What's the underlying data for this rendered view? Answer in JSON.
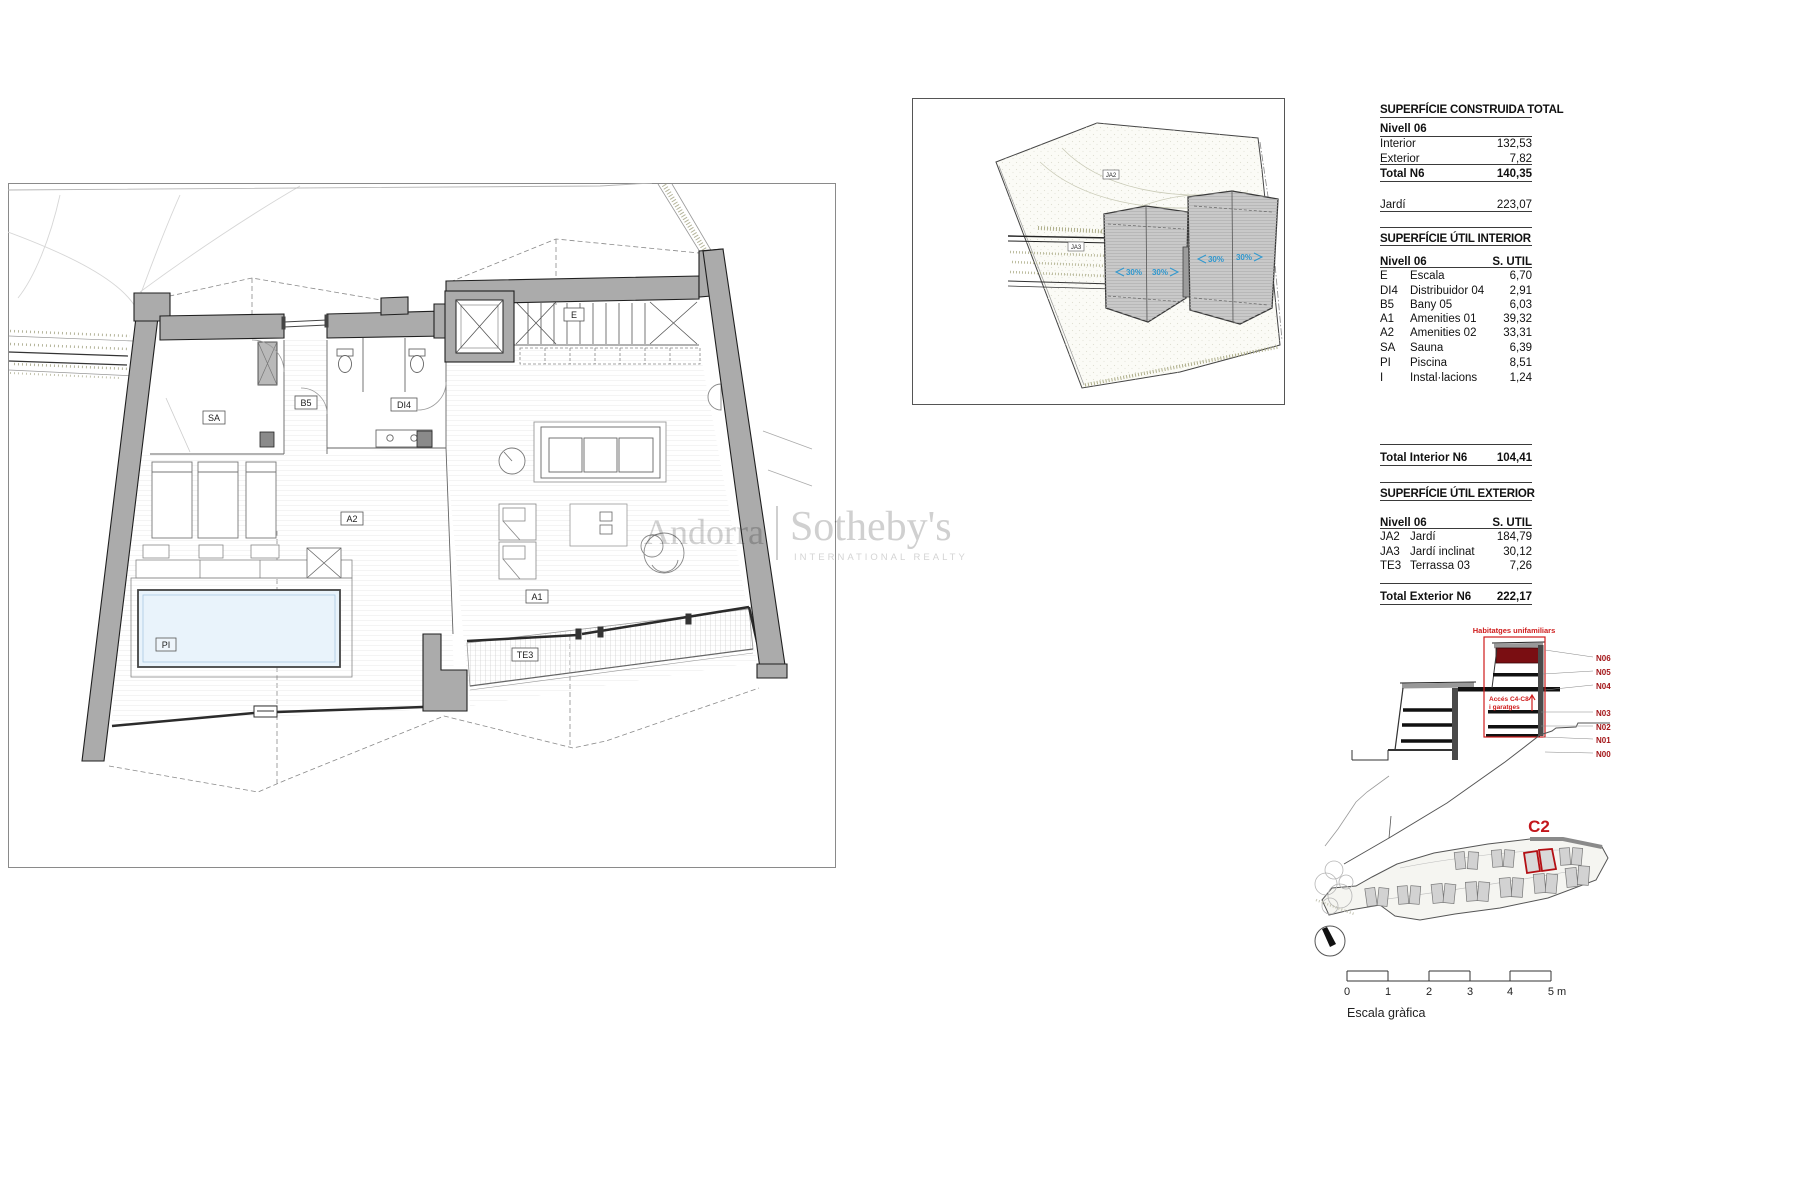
{
  "watermark": {
    "left": "Andorra",
    "right": "Sotheby's",
    "tagline": "INTERNATIONAL REALTY"
  },
  "plan": {
    "labels": {
      "sa": "SA",
      "b5": "B5",
      "di4": "DI4",
      "a2": "A2",
      "a1": "A1",
      "pi": "PI",
      "te3": "TE3",
      "e": "E"
    }
  },
  "site_plan": {
    "labels": {
      "ja2": "JA2",
      "ja3": "JA3"
    },
    "slopes": [
      "30%",
      "30%",
      "30%",
      "30%"
    ]
  },
  "tables": {
    "construida": {
      "title": "SUPERFÍCIE CONSTRUIDA TOTAL",
      "subtitle": "Nivell 06",
      "rows": [
        {
          "label": "Interior",
          "value": "132,53"
        },
        {
          "label": "Exterior",
          "value": "7,82"
        }
      ],
      "total_label": "Total N6",
      "total_value": "140,35",
      "jardi_label": "Jardí",
      "jardi_value": "223,07"
    },
    "util_interior": {
      "title": "SUPERFÍCIE ÚTIL INTERIOR",
      "header_left": "Nivell 06",
      "header_right": "S. UTIL",
      "rows": [
        {
          "code": "E",
          "label": "Escala",
          "value": "6,70"
        },
        {
          "code": "DI4",
          "label": "Distribuidor 04",
          "value": "2,91"
        },
        {
          "code": "B5",
          "label": "Bany 05",
          "value": "6,03"
        },
        {
          "code": "A1",
          "label": "Amenities 01",
          "value": "39,32"
        },
        {
          "code": "A2",
          "label": "Amenities 02",
          "value": "33,31"
        },
        {
          "code": "SA",
          "label": "Sauna",
          "value": "6,39"
        },
        {
          "code": "PI",
          "label": "Piscina",
          "value": "8,51"
        },
        {
          "code": "I",
          "label": "Instal·lacions",
          "value": "1,24"
        }
      ],
      "total_label": "Total Interior N6",
      "total_value": "104,41"
    },
    "util_exterior": {
      "title": "SUPERFÍCIE ÚTIL EXTERIOR",
      "header_left": "Nivell 06",
      "header_right": "S. UTIL",
      "rows": [
        {
          "code": "JA2",
          "label": "Jardí",
          "value": "184,79"
        },
        {
          "code": "JA3",
          "label": "Jardí inclinat",
          "value": "30,12"
        },
        {
          "code": "TE3",
          "label": "Terrassa 03",
          "value": "7,26"
        }
      ],
      "total_label": "Total Exterior N6",
      "total_value": "222,17"
    }
  },
  "section": {
    "caption": "Habitatges unifamiliars",
    "access_line1": "Accés C4-C8",
    "access_line2": "i garatges",
    "levels": [
      "N06",
      "N05",
      "N04",
      "N03",
      "N02",
      "N01",
      "N00"
    ]
  },
  "overview": {
    "unit_label": "C2"
  },
  "scale_bar": {
    "ticks": [
      "0",
      "1",
      "2",
      "3",
      "4"
    ],
    "end_label": "5 m",
    "caption": "Escala gràfica"
  },
  "colors": {
    "accent_red": "#c3161c",
    "dark_red_fill": "#7a0e12",
    "level_label_red": "#a31518",
    "wall_gray": "#ababab",
    "pool_blue": "#e9f3fb",
    "slope_blue": "#2f98cf"
  }
}
